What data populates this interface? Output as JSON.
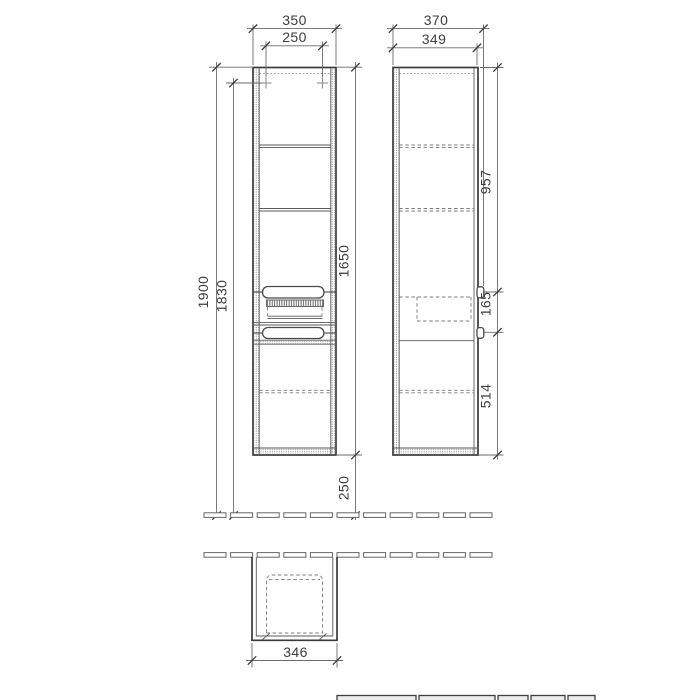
{
  "drawing": {
    "type": "technical-cabinet-drawing",
    "views": [
      "front-elevation",
      "side-elevation",
      "plan-view"
    ]
  },
  "dimensions": {
    "front_width": "350",
    "front_mount_width": "250",
    "side_depth_total": "370",
    "side_depth_body": "349",
    "height_floor_to_top": "1900",
    "height_floor_to_mount": "1830",
    "body_height": "1650",
    "bottom_clearance": "250",
    "top_to_upper_handle": "957",
    "handle_spacing": "165",
    "lower_handle_to_bottom": "514",
    "plan_depth": "346"
  },
  "colors": {
    "background": "#ffffff",
    "line": "#3a3a3a",
    "thin_line": "#5a5a5a",
    "dashed_line": "#7a7a7a",
    "hatch": "#9a9a9a",
    "text": "#3d3d3d"
  }
}
